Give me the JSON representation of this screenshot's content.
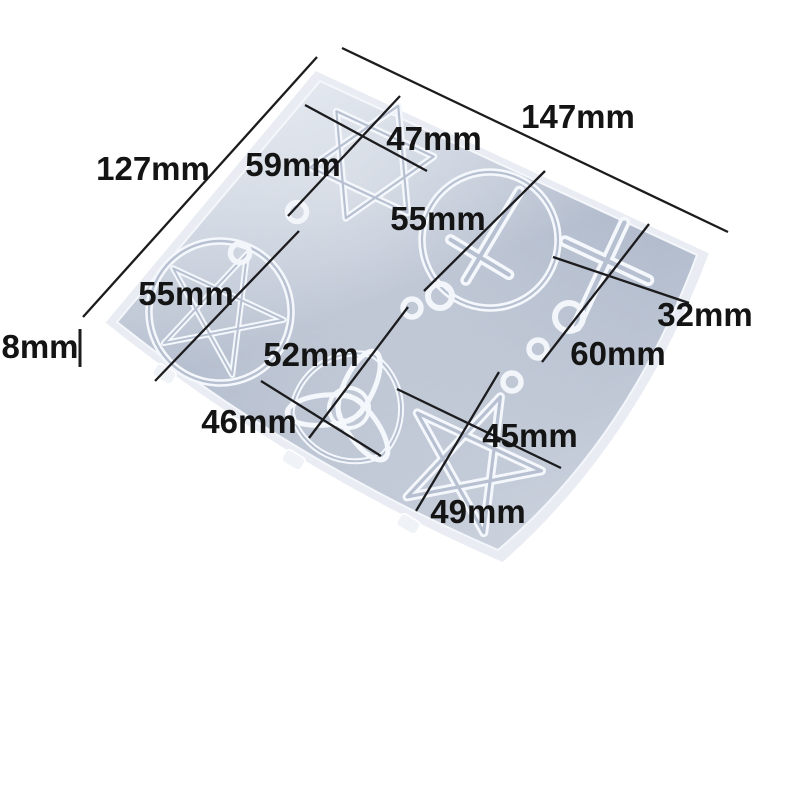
{
  "photo": {
    "background_color": "#ffffff",
    "subject": "silicone-pendant-mold-perspective-shot",
    "mold": {
      "colors": {
        "plate_rim": "#e9edf3",
        "plate_floor": "#aeb8ca",
        "cavity_outline": "#f4f7fb",
        "dimension_line": "#1c1c1e",
        "label_text": "#141414"
      },
      "cavities": [
        "hexagram-star",
        "circle-inverted-cross",
        "latin-cross",
        "pentacle",
        "trinity-knot",
        "pentagram-star"
      ],
      "dimensions": {
        "plate": {
          "width": "147mm",
          "height": "127mm",
          "thickness": "8mm"
        },
        "hexagram_star": {
          "a": "47mm",
          "b": "59mm"
        },
        "circle_inverted_cross": {
          "diameter": "55mm"
        },
        "pentacle": {
          "diameter": "55mm"
        },
        "latin_cross": {
          "width": "32mm",
          "height": "60mm"
        },
        "trinity_knot": {
          "a": "52mm",
          "b": "46mm"
        },
        "pentagram_star": {
          "a": "45mm",
          "b": "49mm"
        }
      }
    }
  }
}
